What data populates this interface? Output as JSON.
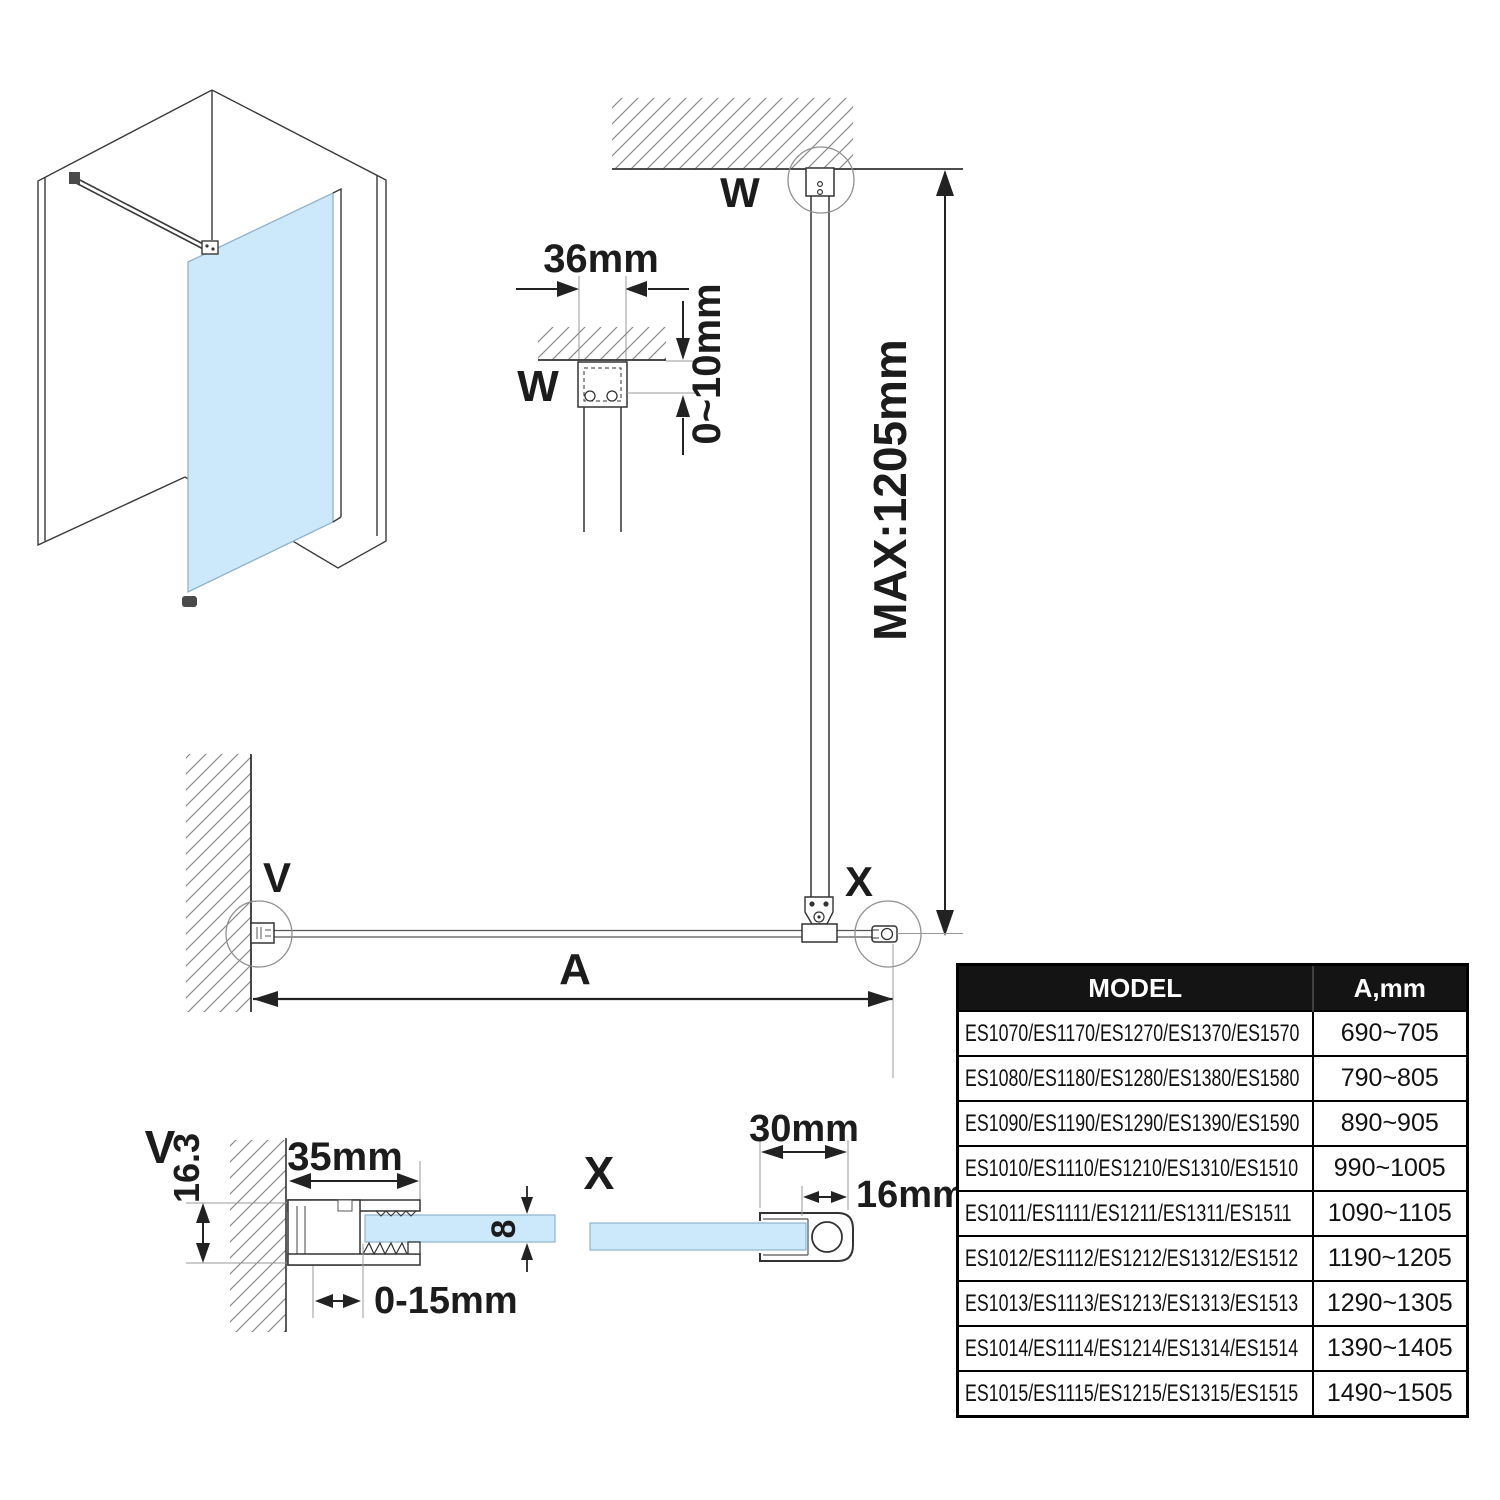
{
  "colors": {
    "glass": "#cbe9fa",
    "glass_edge": "#8fb3cc",
    "table_header_bg": "#141414",
    "table_header_text": "#ffffff",
    "line": "#333333"
  },
  "plan": {
    "label_w": "W",
    "label_v": "V",
    "label_x": "X",
    "dim_a": "A",
    "dim_max": "MAX:1205mm"
  },
  "detail_w": {
    "label": "W",
    "dim_width": "36mm",
    "dim_gap": "0~10mm"
  },
  "detail_v": {
    "label": "V",
    "dim_depth": "16.3",
    "dim_width": "35mm",
    "dim_adjust": "0-15mm",
    "dim_glass_thickness": "8"
  },
  "detail_x": {
    "label": "X",
    "dim_width": "30mm",
    "dim_tube": "16mm"
  },
  "table": {
    "header_model": "MODEL",
    "header_a": "A,mm",
    "rows": [
      {
        "model": "ES1070/ES1170/ES1270/ES1370/ES1570",
        "a": "690~705"
      },
      {
        "model": "ES1080/ES1180/ES1280/ES1380/ES1580",
        "a": "790~805"
      },
      {
        "model": "ES1090/ES1190/ES1290/ES1390/ES1590",
        "a": "890~905"
      },
      {
        "model": "ES1010/ES1110/ES1210/ES1310/ES1510",
        "a": "990~1005"
      },
      {
        "model": "ES1011/ES1111/ES1211/ES1311/ES1511",
        "a": "1090~1105"
      },
      {
        "model": "ES1012/ES1112/ES1212/ES1312/ES1512",
        "a": "1190~1205"
      },
      {
        "model": "ES1013/ES1113/ES1213/ES1313/ES1513",
        "a": "1290~1305"
      },
      {
        "model": "ES1014/ES1114/ES1214/ES1314/ES1514",
        "a": "1390~1405"
      },
      {
        "model": "ES1015/ES1115/ES1215/ES1315/ES1515",
        "a": "1490~1505"
      }
    ]
  }
}
